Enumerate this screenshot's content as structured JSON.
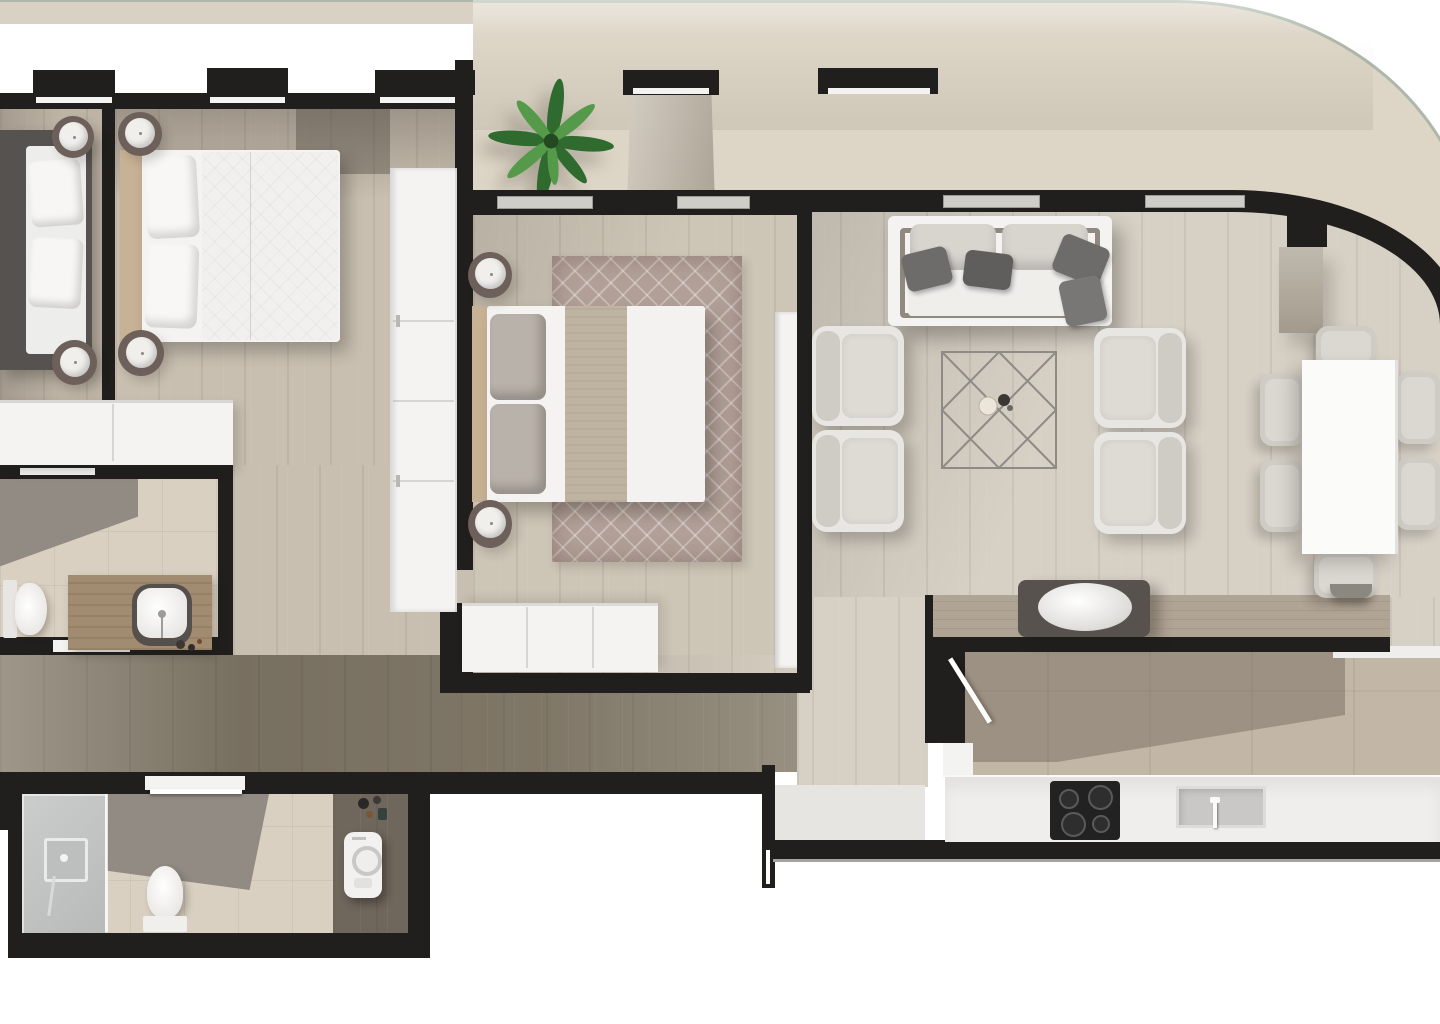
{
  "plan_title": "apartment-floor-plan-top-view",
  "palette": {
    "wall": "#201f1d",
    "wood_light": "#c8bfb0",
    "wood_pale": "#d6d0c5",
    "wood_mid": "#b0a494",
    "wood_dark": "#89806f",
    "exterior_band": "#d8d1c4",
    "balcony_tile": "#ddd5c6",
    "bath_tile": "#d9d0c1",
    "dark_tile": "#918b83",
    "kitchen_tile": "#c2b6a7",
    "furniture_white": "#f4f3f1",
    "cushion_grey": "#cfccc6",
    "cushion_light": "#e8e6e2",
    "pillow_dark": "#6d6c6a",
    "rug_base": "#b2a098",
    "headboard_wood": "#c8b295",
    "runner_tan": "#bfb3a1",
    "glass_rail": "#adb8aa",
    "glass_door": "#cfcdc8",
    "counter_white": "#efeeec",
    "appliance_dark": "#222222",
    "steel_grey": "#c9c8c6",
    "plant_dark": "#2f6b2e",
    "plant_light": "#559a4a",
    "vanity_wood": "#a28c71",
    "column_grey": "#c0baae",
    "lamp_base": "#6d5f5a",
    "lamp_white": "#f1efec",
    "bed_dark": "#55524f"
  },
  "rooms": {
    "balcony": {
      "name": "balcony-terrace",
      "furniture": [
        "palm-plant",
        "concrete-column",
        "planter-box",
        "glass-railing"
      ]
    },
    "bedroom1": {
      "name": "bedroom-1",
      "furniture": [
        "double-bed-dark",
        "nightstand-lamp",
        "nightstand-lamp",
        "low-dresser"
      ]
    },
    "bedroom2": {
      "name": "bedroom-2",
      "furniture": [
        "double-bed",
        "nightstand-lamp",
        "nightstand-lamp",
        "wardrobe"
      ]
    },
    "master": {
      "name": "master-bedroom",
      "furniture": [
        "double-bed",
        "area-rug",
        "nightstand-lamp",
        "nightstand-lamp",
        "dresser",
        "wardrobe",
        "sliding-glass-door",
        "sliding-glass-door"
      ]
    },
    "bathroom1": {
      "name": "bathroom-1",
      "furniture": [
        "toilet",
        "vanity-counter",
        "vessel-sink"
      ]
    },
    "corridor": {
      "name": "corridor",
      "furniture": []
    },
    "hallway": {
      "name": "hallway",
      "furniture": []
    },
    "entry": {
      "name": "entry-vestibule",
      "furniture": [
        "entrance-door"
      ]
    },
    "bathroom2": {
      "name": "bathroom-2",
      "furniture": [
        "walk-in-shower",
        "toilet",
        "washing-machine"
      ]
    },
    "living": {
      "name": "living-room",
      "furniture": [
        "sofa",
        "armchair",
        "armchair",
        "armchair",
        "armchair",
        "coffee-table",
        "sliding-glass-door",
        "sliding-glass-door"
      ]
    },
    "dining": {
      "name": "dining-area",
      "furniture": [
        "dining-table",
        "dining-chair",
        "dining-chair",
        "dining-chair",
        "dining-chair",
        "dining-chair",
        "dining-chair"
      ]
    },
    "kitchen": {
      "name": "kitchen",
      "furniture": [
        "peninsula-counter",
        "serving-bowl",
        "base-counter",
        "cooktop",
        "sink",
        "kitchen-door"
      ]
    }
  }
}
